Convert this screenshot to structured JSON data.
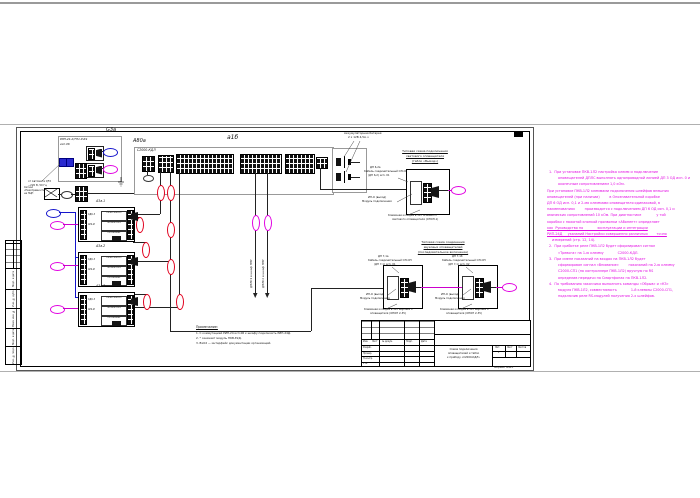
{
  "page": {
    "format_label": "Формат А4х3"
  },
  "psu": {
    "designator": "G3а",
    "model": "РИП-24-2/7П1-Р-RS",
    "variant": "исп.06",
    "mains_label_1": "от Автомата QF2",
    "mains_label_2": "~220 В, 50 Гц",
    "fault_label_1": "Сигнал",
    "fault_label_2": "«Неисправность»",
    "fault_label_3": "на ПЦН"
  },
  "kdl": {
    "designator": "А80а",
    "model": "С2000-КДЛ",
    "group_tag": "а1б",
    "battery_label_1": "Аккумуляторная батарея",
    "battery_label_2": "2 х 12В 4,5А·ч"
  },
  "blocks": {
    "items": [
      {
        "designator": "А3а.1",
        "left_1": "СДК-3",
        "left_2": "АР2-И",
        "cell_1": "ПК-ВХ 3000-1У",
        "cell_2": "ПК-Реле тест",
        "cell_3": "ПК-Питание"
      },
      {
        "designator": "А3а.2",
        "left_1": "СДК-3",
        "left_2": "АР2-И",
        "cell_1": "ПК-ВХ 3000-1У",
        "cell_2": "ПК-Реле тест",
        "cell_3": "ПК-Питание"
      },
      {
        "designator": "А3а.3",
        "left_1": "СДК-3",
        "left_2": "АР2-И",
        "cell_1": "ПК-ВХ 3000-1У",
        "cell_2": "ПК-Реле тест",
        "cell_3": "ПК-Питание"
      }
    ]
  },
  "risers": {
    "left_label": "ДПЛС1 в шкаф ППУ",
    "right_label": "ДПЛС2 в шкаф ППУ"
  },
  "sub_top": {
    "title_1": "Типовая схема подключения",
    "title_2": "светового оповещателя",
    "title_3": "(табло «Выход»)",
    "cable_1": "ДП 6,2а",
    "cable_2": "Кабель соединительный ОП-ОП",
    "cable_3": "(ДП 6,2) исп. 01",
    "module_1": "ИП-О (выход)",
    "module_2": "Модуль подключения",
    "bottom_1": "Клеммная колодка в ЗРУ основного",
    "bottom_2": "светового оповещателя (ОПОП-1)"
  },
  "sub_bottom": {
    "title_1": "Типовая схема соединения",
    "title_2": "звуковых оповещателей",
    "title_3": "(последовательное включение)",
    "cable_a_1": "ДП 7,1а",
    "cable_a_2": "Кабель соединительный ОП-ОП",
    "cable_a_3": "(ДП 7,1) исп. 01",
    "cable_b_1": "ДП 7,1б",
    "cable_b_2": "Кабель соединительный ОП-ОП",
    "cable_b_3": "(ДП 7,1) исп. 02",
    "module_a_1": "ИП-О (выход)",
    "module_a_2": "Модуль подключения",
    "module_b_1": "ИП-О (выход)",
    "module_b_2": "Модуль подключения",
    "bottom_a_1": "Клеммная колодка в ЗРУ звукового",
    "bottom_a_2": "оповещателя (ОПОП 2-35)",
    "bottom_b_1": "Клеммная колодка в ЗРУ звукового",
    "bottom_b_2": "оповещателя (ОПОП 2-35)"
  },
  "notes_small": {
    "header": "Примечание:",
    "item_1": "1. С коммутацией РИП-24 исп.06 к шкафу подключить РИП-24Д.",
    "item_2": "2. * означает модуль ПКВ-Е2Д.",
    "item_3": "3. ВхО2 — интерфейс документации организаций."
  },
  "notes_pink": {
    "lines": [
      "1.  При установке ПКВ-1Л2 настройка клемм и подключение",
      "оповещателей ДПЛС выполнять однопроводной линией ДП 3 ОД исп. 0 и",
      "оконечным сопротивлением 1,0 кОм.",
      "При установке ПКВ-1Л2 клеммами подключения шлейфов внешних",
      "оповещателей (при наличии)         в Опознавательной коробке",
      "ДП 6 ОД исп. 0,1 и 2-мя клеммами оповещателя одинаковой, в",
      "наименованиях         производится с подключением ДП 6 ОД исп. 0,1 и",
      "омических сопротивлений 10 кОм. При диагностике              у той",
      "коробки с нажатой кнопкой прозвонки «Абонент» определяет",
      "как  Руководство по             эксплуатации и интеграции",
      "РИП-24Д     указаний Настройки совершенно различных        точно",
      "измерений (стр. 12, 14).",
      "2.  При сработке реле ПКВ-1Л2 будет сформирован сигнал",
      "«Тревога» на 1-ю клемму             С2000-КДЛ.",
      "3.  При смене показаний на входах на ПКВ-1Л2 будет",
      "сформирован сигнал «Внимание»         показаний на 2-ю клемму",
      "С2000-СП1 (на контроллере ПКВ-1Л2) вручную по RS",
      "определив передачи на Смартфонах на ПКВ-1Л2.",
      "4.  По требованию заказчика выполнить команды «Обрыв» и «КЗ»",
      "модуля ПКВ-1Л2, совместимость             1-й клеммы С2000-СП1,",
      "подключив реле RS-модулей получения 2-х шлейфов."
    ]
  },
  "title_block": {
    "col_headers": [
      "Изм.",
      "Лист",
      "№ докум.",
      "Подп.",
      "Дата"
    ],
    "row_labels": [
      "Разраб.",
      "Провер.",
      "Н.контр.",
      "Утв."
    ],
    "title_1": "Схема подключения",
    "title_2": "оповещателей и табло",
    "title_3": "к прибору «С2000-КДЛ»",
    "lit_headers": [
      "Лит.",
      "Лист",
      "Листов"
    ],
    "lit_value": "Р"
  },
  "left_strip": {
    "cell_1": "Подп. и дата",
    "cell_2": "Инв. № дубл.",
    "cell_3": "Взам. инв. №",
    "cell_4": "Подп. и дата",
    "cell_5": "Инв. № подл."
  }
}
